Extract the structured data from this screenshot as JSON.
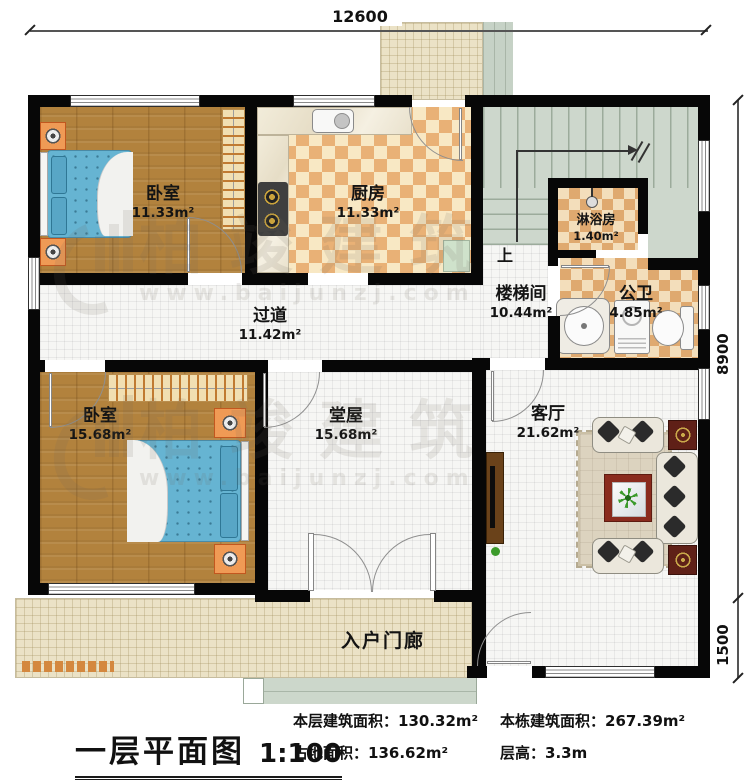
{
  "dimensions": {
    "top_width": "12600",
    "right_height_main": "8900",
    "right_height_porch": "1500"
  },
  "rooms": [
    {
      "name": "卧室",
      "area": "11.33m²"
    },
    {
      "name": "厨房",
      "area": "11.33m²"
    },
    {
      "name": "淋浴房",
      "area": "1.40m²"
    },
    {
      "name": "楼梯间",
      "area": "10.44m²"
    },
    {
      "name": "公卫",
      "area": "4.85m²"
    },
    {
      "name": "过道",
      "area": "11.42m²"
    },
    {
      "name": "卧室",
      "area": "15.68m²"
    },
    {
      "name": "堂屋",
      "area": "15.68m²"
    },
    {
      "name": "客厅",
      "area": "21.62m²"
    },
    {
      "name": "入户门廊"
    }
  ],
  "stairs": {
    "direction_label": "上"
  },
  "watermark": {
    "brand": "柏竣建筑",
    "website": "www.baijunzj.com"
  },
  "title_block": {
    "title": "一层平面图",
    "scale": "1:100",
    "stats": [
      {
        "label": "本层建筑面积：",
        "value": "130.32m²"
      },
      {
        "label": "占地面积：",
        "value": "136.62m²"
      },
      {
        "label": "本栋建筑面积：",
        "value": "267.39m²"
      },
      {
        "label": "层高：",
        "value": "3.3m"
      }
    ]
  },
  "colors": {
    "wall": "#070707",
    "wood_floor": "#b2823d",
    "checker_orange": "#e9b176",
    "checker_cream": "#f8e8c4",
    "stair_green": "#cdd7cc",
    "porch_beige": "#ebe2c6",
    "bed_blue": "#66b4d2",
    "nightstand_orange": "#ef9a55",
    "table_red": "#8a2b1d"
  }
}
